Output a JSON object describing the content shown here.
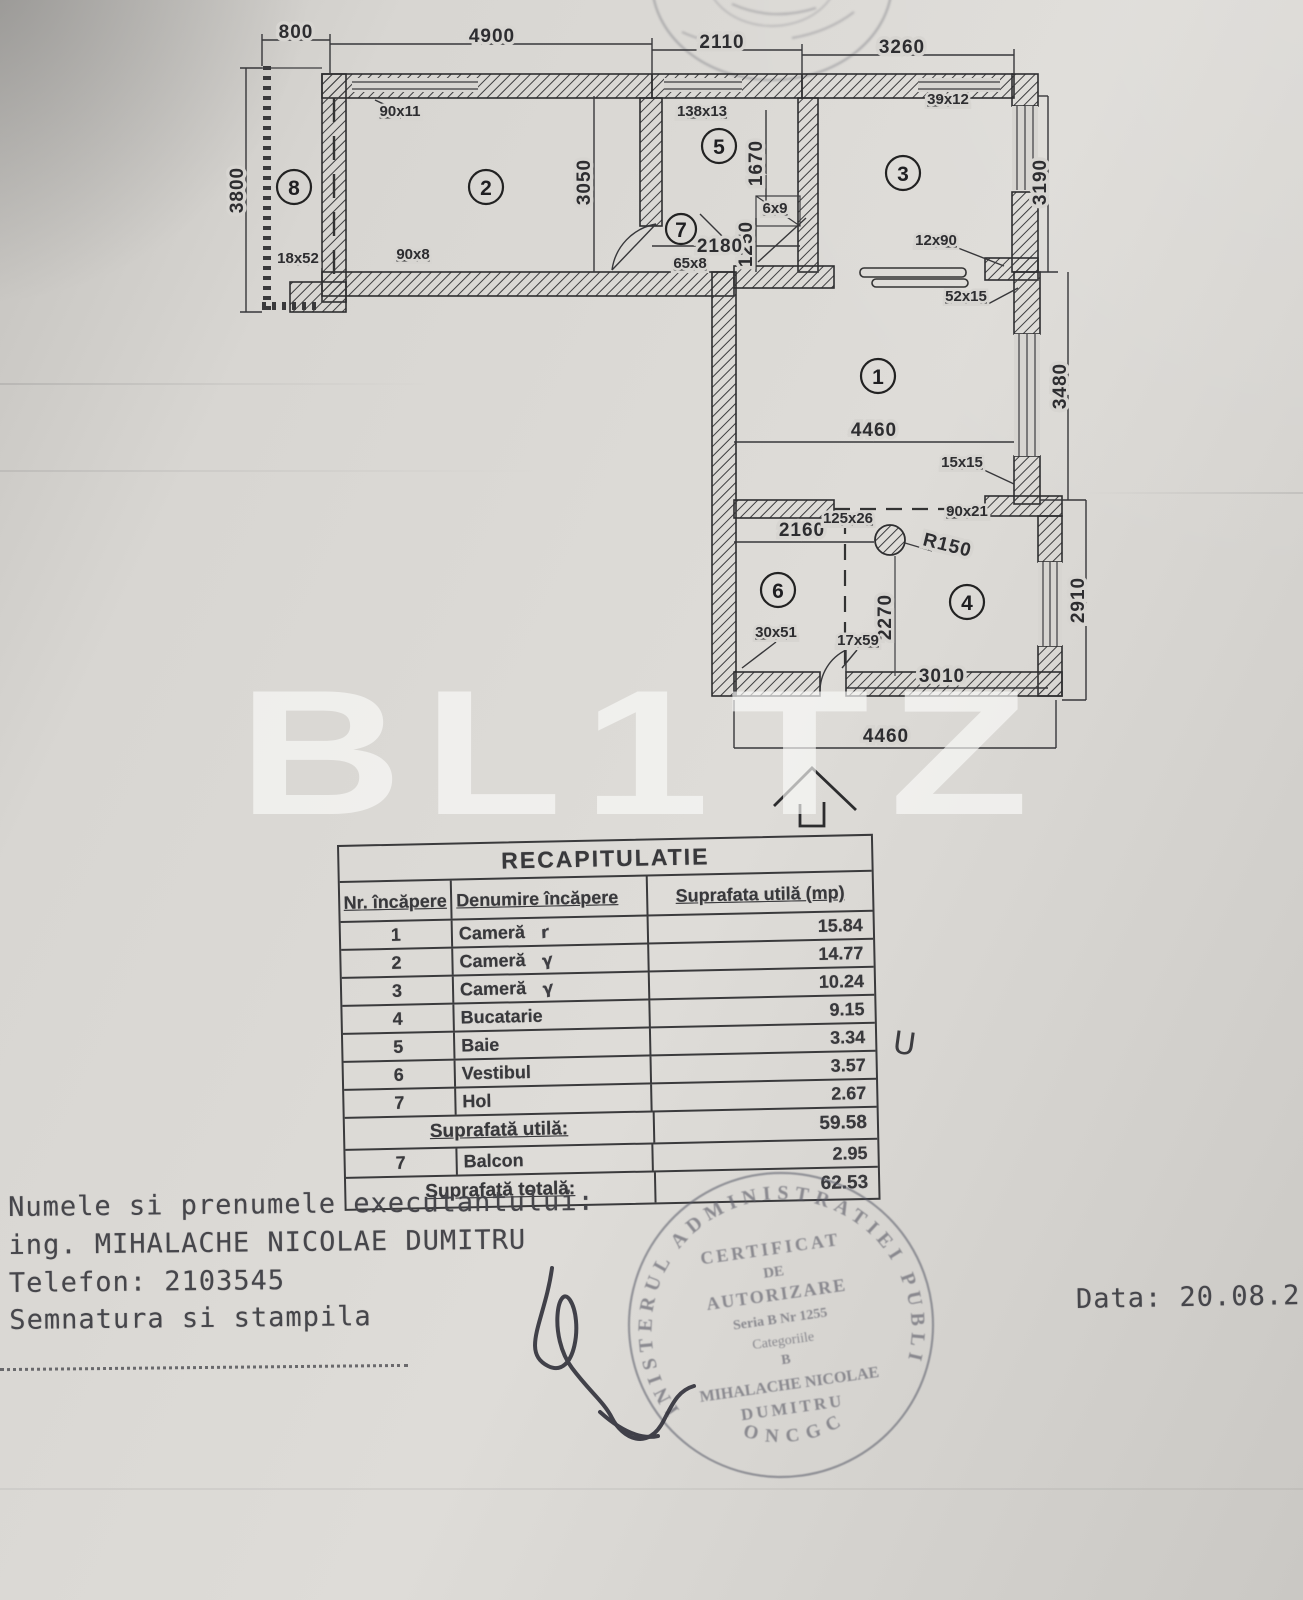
{
  "document": {
    "watermark": "BL1TZ",
    "date": "Data: 20.08.2"
  },
  "plan": {
    "rooms": {
      "n1": "1",
      "n2": "2",
      "n3": "3",
      "n4": "4",
      "n5": "5",
      "n6": "6",
      "n7": "7",
      "n8": "8"
    },
    "dims": {
      "top_800": "800",
      "top_4900": "4900",
      "top_2110": "2110",
      "top_3260": "3260",
      "left_3800": "3800",
      "room2_3050": "3050",
      "room5_1670": "1670",
      "room3_3190": "3190",
      "room1_3480": "3480",
      "room4_2910": "2910",
      "room7_1250": "1250",
      "room7_2180": "2180",
      "room1_4460": "4460",
      "room6_2160": "2160",
      "room4_2270": "2270",
      "room4_3010": "3010",
      "bottom_4460": "4460",
      "radius": "R150"
    },
    "tags": {
      "t90x11": "90x11",
      "t138x13": "138x13",
      "t39x12": "39x12",
      "t18x52": "18x52",
      "t90x8": "90x8",
      "t6x9": "6x9",
      "t65x8": "65x8",
      "t12x90": "12x90",
      "t52x15": "52x15",
      "t15x15": "15x15",
      "t125x26": "125x26",
      "t90x21": "90x21",
      "t30x51": "30x51",
      "t17x59": "17x59"
    }
  },
  "table": {
    "title": "RECAPITULATIE",
    "headers": {
      "nr": "Nr. încăpere",
      "name": "Denumire încăpere",
      "area": "Suprafata utilă (mp)"
    },
    "rows": [
      {
        "nr": "1",
        "name": "Cameră",
        "mark": "r",
        "area": "15.84"
      },
      {
        "nr": "2",
        "name": "Cameră",
        "mark": "γ",
        "area": "14.77"
      },
      {
        "nr": "3",
        "name": "Cameră",
        "mark": "γ",
        "area": "10.24"
      },
      {
        "nr": "4",
        "name": "Bucatarie",
        "area": "9.15"
      },
      {
        "nr": "5",
        "name": "Baie",
        "area": "3.34"
      },
      {
        "nr": "6",
        "name": "Vestibul",
        "area": "3.57"
      },
      {
        "nr": "7",
        "name": "Hol",
        "area": "2.67"
      }
    ],
    "subtotal_label": "Suprafată utilă:",
    "subtotal_value": "59.58",
    "balcon_row": {
      "nr": "7",
      "name": "Balcon",
      "area": "2.95"
    },
    "total_label": "Suprafată totală:",
    "total_value": "62.53",
    "annotation": "U"
  },
  "footer": {
    "line1": "Numele si prenumele executantului:",
    "line2": "ing. MIHALACHE NICOLAE DUMITRU",
    "line3": "Telefon: 2103545",
    "line4": "Semnatura si stampila"
  },
  "stamp": {
    "ring_top": "MINISTERUL ADMINISTRATIEI PUBLICE",
    "ring_bottom": "ONCGC",
    "l1": "CERTIFICAT",
    "l2": "DE",
    "l3": "AUTORIZARE",
    "l4": "Seria B Nr 1255",
    "l5": "Categoriile",
    "l6": "B",
    "l7": "MIHALACHE NICOLAE",
    "l8": "DUMITRU"
  }
}
